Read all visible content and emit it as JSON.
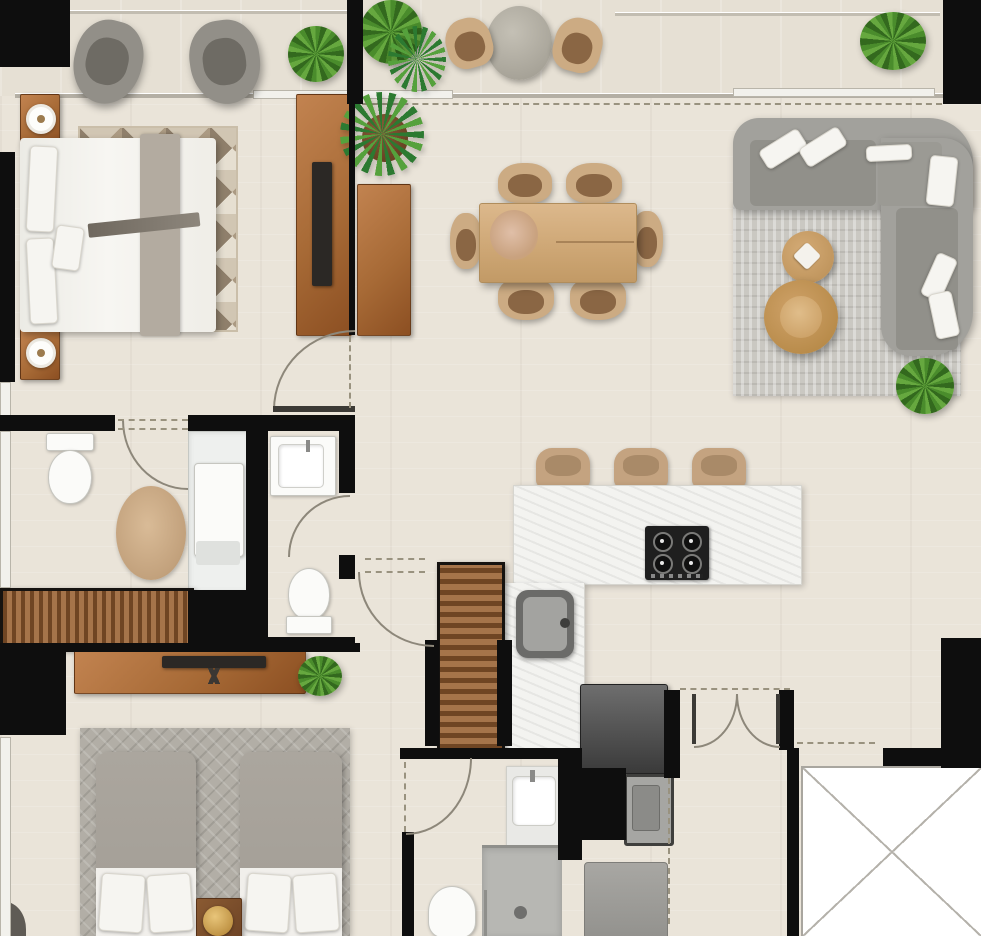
{
  "scene": {
    "type": "residential apartment floor plan",
    "view": "top-down furnished render",
    "canvas": {
      "width": 981,
      "height": 936
    }
  },
  "palette": {
    "floor": "#eae4d9",
    "balcony_floor": "#e6e0d4",
    "wall": "#0e0e0e",
    "wood": "#a5744a",
    "wood_table": "#d2ad83",
    "counter_white": "#f3f3f0",
    "sofa_gray": "#a2a19c",
    "cushion_white": "#f4f3ef",
    "rug_gray": "#cac8c2",
    "rug_taupe": "#a8977f",
    "bed_white": "#f3f1ec",
    "bed_gray": "#a7a29a",
    "chair_tan": "#ccab83",
    "plant_green": "#4a8c2c",
    "appliance_gray": "#4a4a4a",
    "fixture_white": "#fbfbf9",
    "gold_lamp": "#cfa254"
  },
  "rooms": [
    {
      "id": "balcony",
      "furniture": [
        "lounge-chair",
        "lounge-chair",
        "potted-plant",
        "tall-plants",
        "round-bistro-table",
        "bistro-chair",
        "bistro-chair",
        "potted-plant"
      ]
    },
    {
      "id": "master-bedroom",
      "furniture": [
        "double-bed",
        "nightstand-with-lamp",
        "nightstand-with-lamp",
        "geometric-area-rug",
        "media-console-with-tv"
      ]
    },
    {
      "id": "entry-hall",
      "furniture": [
        "console-table",
        "palm-plant"
      ]
    },
    {
      "id": "dining-area",
      "furniture": [
        "wood-dining-table",
        "dining-chair",
        "dining-chair",
        "dining-chair",
        "dining-chair",
        "dining-chair",
        "dining-chair",
        "table-centerpiece"
      ]
    },
    {
      "id": "living-area",
      "furniture": [
        "corner-sectional-sofa",
        "area-rug",
        "round-coffee-table-small",
        "round-coffee-table-large",
        "potted-plant"
      ]
    },
    {
      "id": "kitchen",
      "furniture": [
        "l-shaped-counter",
        "gas-hob-4-burners",
        "kitchen-sink",
        "bar-stool",
        "bar-stool",
        "bar-stool",
        "louvered-pantry",
        "refrigerator",
        "washing-machine",
        "utility-appliance"
      ]
    },
    {
      "id": "master-bathroom",
      "furniture": [
        "toilet",
        "shower-stall",
        "oval-rug",
        "louvered-wardrobe"
      ]
    },
    {
      "id": "bathroom-middle",
      "furniture": [
        "washbasin",
        "toilet"
      ]
    },
    {
      "id": "bathroom-lower",
      "furniture": [
        "washbasin-vanity",
        "shower",
        "toilet"
      ]
    },
    {
      "id": "second-bedroom",
      "furniture": [
        "single-bed",
        "single-bed",
        "shared-nightstand-with-gold-lamp",
        "patterned-rug",
        "media-console-with-tv",
        "potted-plant"
      ]
    },
    {
      "id": "entry-corridor",
      "furniture": [
        "double-entry-doors",
        "elevator-shaft-x"
      ]
    }
  ],
  "doors": [
    "master-bedroom-door",
    "master-bath-opening",
    "middle-bathroom-door",
    "hall-closet-door",
    "second-bedroom-door",
    "double-entry-doors"
  ],
  "counts": {
    "bedrooms": 2,
    "bathrooms": 3,
    "balconies": 1,
    "plants": 7,
    "door_arcs": 7
  }
}
